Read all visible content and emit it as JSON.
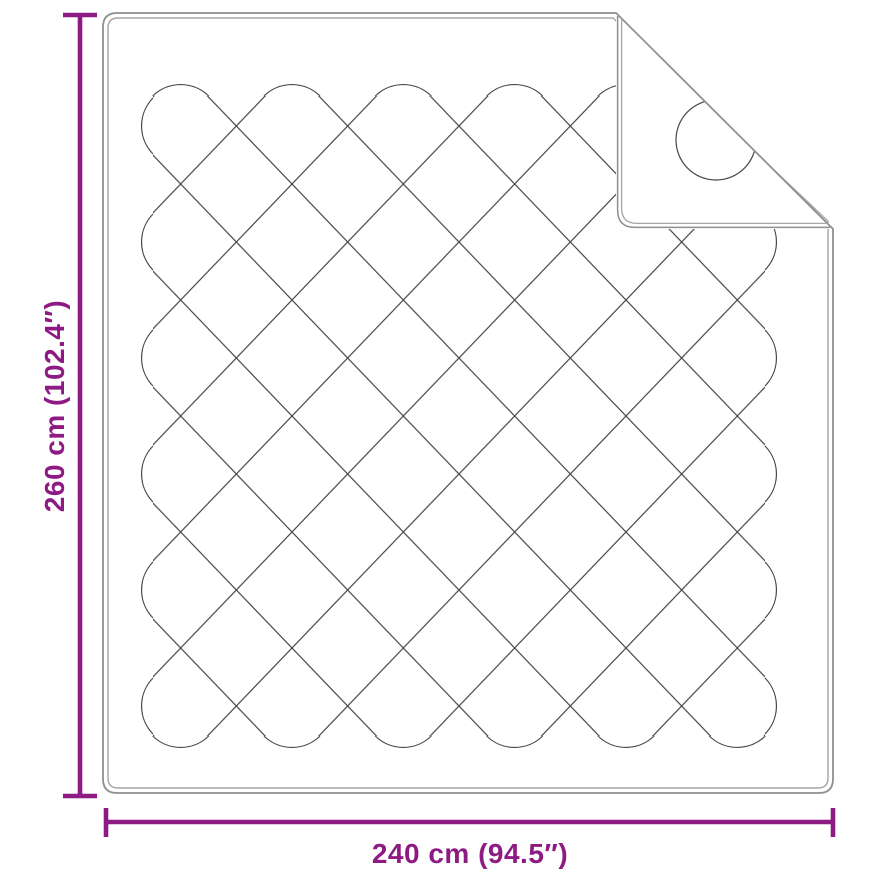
{
  "dimensions": {
    "height": {
      "label": "260 cm (102.4″)"
    },
    "width": {
      "label": "240 cm (94.5″)"
    }
  },
  "colors": {
    "dimension": "#8e1b83",
    "outline": "#8f8f8f",
    "trim": "#a6a6a6",
    "stitch": "#474747"
  }
}
